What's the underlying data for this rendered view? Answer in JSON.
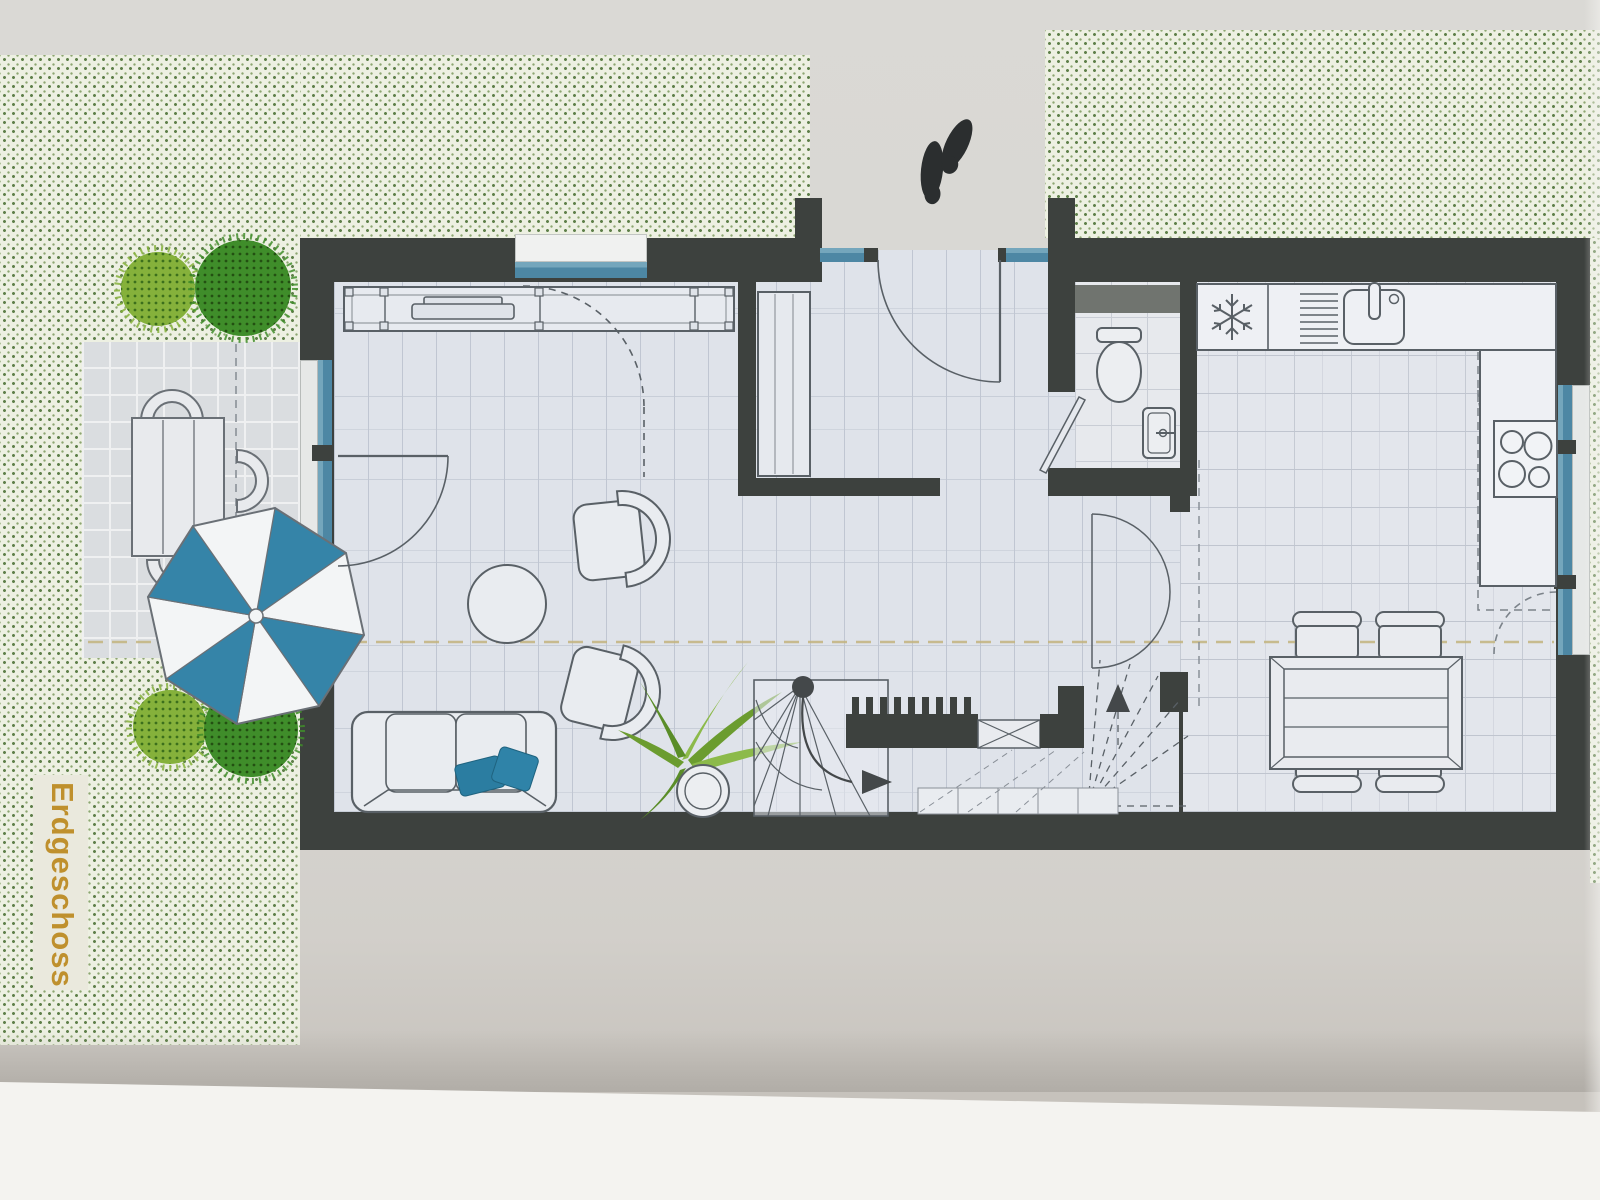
{
  "floor_plan": {
    "label": "Erdgeschoss",
    "label_color": "#bf902d",
    "wall_color": "#3d413e",
    "window_glass_color": "#4d87a4",
    "lawn_dot_color": "#5f804a",
    "umbrella_color": "#3584a8",
    "pillow_color": "#2b7da1",
    "tree_colors": {
      "light": "#85b13b",
      "dark": "#3f8d2a"
    },
    "section_line_color": "#c3b47e",
    "icons": {
      "footprints": "entrance-footprints",
      "snowflake": "❄",
      "stair_up_arrow": "▲",
      "stair_direction_arrow": "►"
    }
  }
}
